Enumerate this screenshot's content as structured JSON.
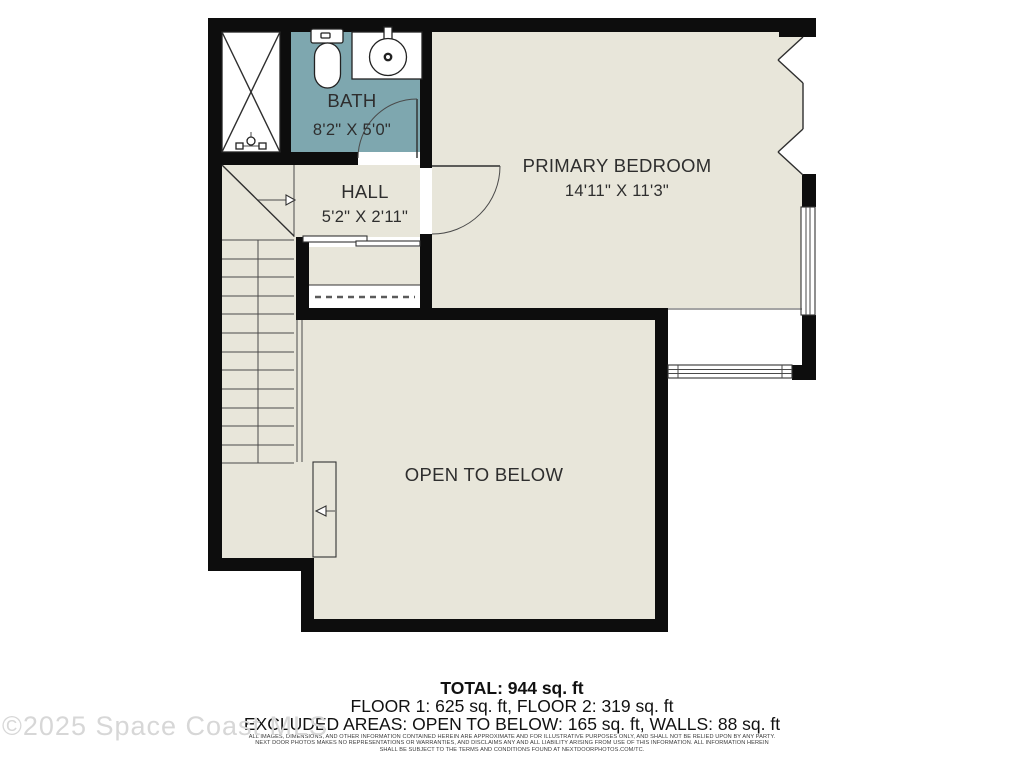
{
  "plan": {
    "rooms": {
      "bath": {
        "name": "BATH",
        "dims": "8'2\" X 5'0\""
      },
      "hall": {
        "name": "HALL",
        "dims": "5'2\" X 2'11\""
      },
      "primary_bedroom": {
        "name": "PRIMARY BEDROOM",
        "dims": "14'11\" X 11'3\""
      },
      "open_to_below": {
        "name": "OPEN TO BELOW"
      }
    },
    "colors": {
      "floor_fill": "#E8E6DA",
      "bath_fill": "#7EA7AF",
      "wall": "#0D0D0D",
      "line": "#2E2E2E"
    }
  },
  "summary": {
    "total": "TOTAL: 944 sq. ft",
    "floors": "FLOOR 1: 625 sq. ft, FLOOR 2: 319 sq. ft",
    "excluded": "EXCLUDED AREAS: OPEN TO BELOW: 165 sq. ft, WALLS: 88 sq. ft"
  },
  "disclaimer": {
    "line1": "ALL IMAGES, DIMENSIONS, AND OTHER INFORMATION CONTAINED HEREIN ARE APPROXIMATE AND FOR ILLUSTRATIVE PURPOSES ONLY, AND SHALL NOT BE RELIED UPON BY ANY PARTY.",
    "line2": "NEXT DOOR PHOTOS MAKES NO REPRESENTATIONS OR WARRANTIES, AND DISCLAIMS ANY AND ALL LIABILITY ARISING FROM USE OF THIS INFORMATION. ALL INFORMATION HEREIN",
    "line3": "SHALL BE SUBJECT TO THE TERMS AND CONDITIONS FOUND AT NEXTDOORPHOTOS.COM/TC."
  },
  "watermark": "©2025 Space Coast MLS"
}
